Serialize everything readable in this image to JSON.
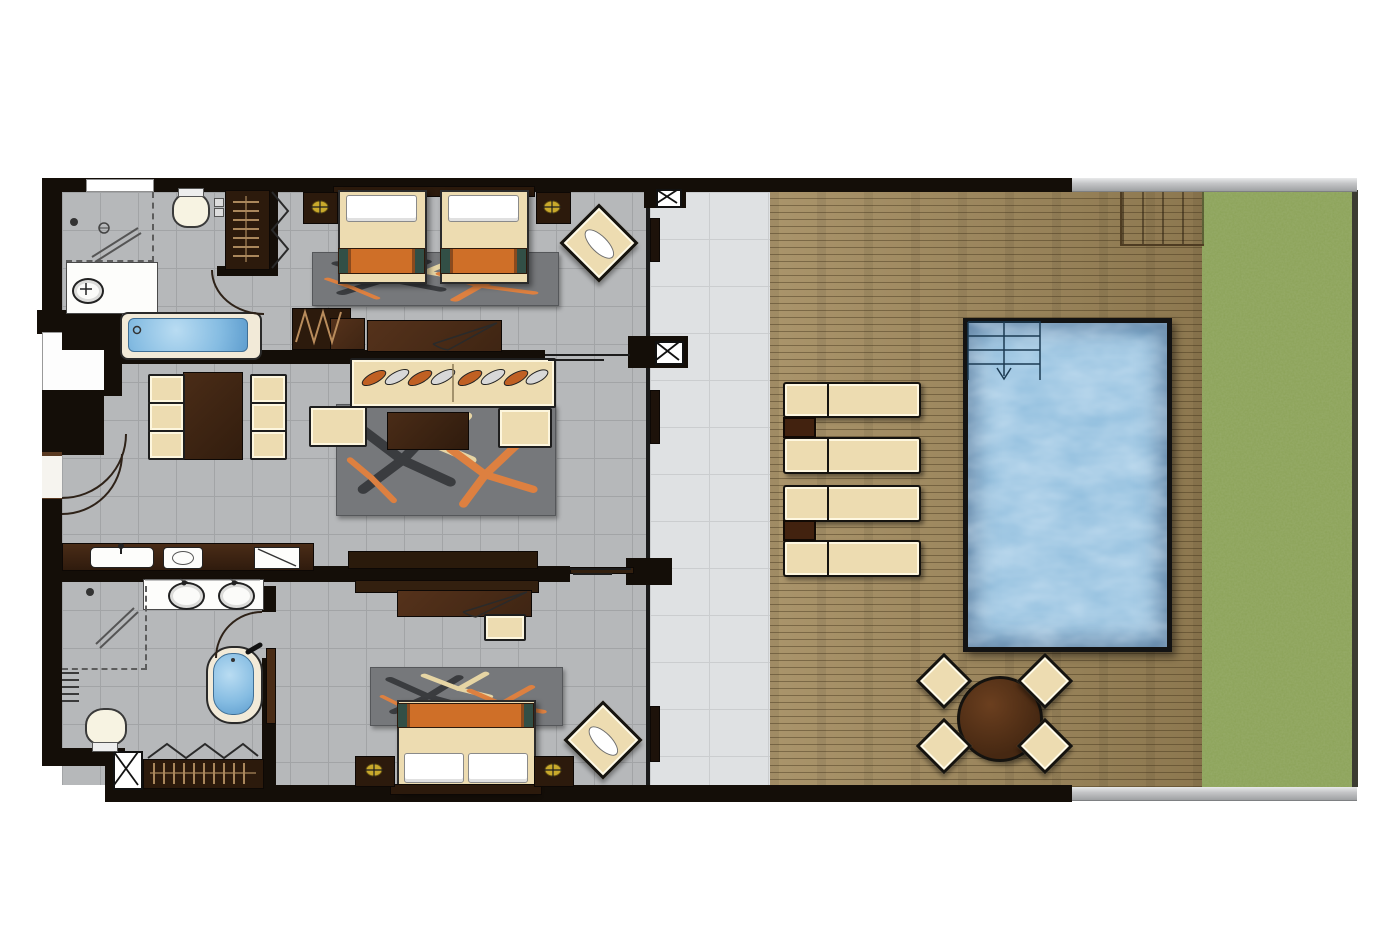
{
  "document": {
    "kind": "floor-plan",
    "text_labels": []
  },
  "colors": {
    "wall": "#140e08",
    "woodDark": "#2c1a0c",
    "wood": "#3f2513",
    "woodMid": "#55321b",
    "cream": "#eddcb1",
    "orange": "#cf6f28",
    "teal": "#324f46",
    "rugGray": "#76787b",
    "rugOrange": "#dd8040",
    "rugCream": "#e6d5a4",
    "rugCharcoal": "#3a3c3f",
    "tile": "#b6b8ba",
    "tileLine": "#a2a4a6",
    "terrace": "#dfe1e3",
    "terraceLine": "#cbcdcf",
    "deck": "#a0885a",
    "lawn": "#8ba257",
    "pool": "#8fbddd",
    "poolFrame": "#131313",
    "tubWater": "#85bce2",
    "grayBand": "#c5c6c8",
    "line": "#1e1e1e",
    "gold": "#c9a92c",
    "hanger": "#c09a6a",
    "glass": "#1a1a1a"
  },
  "plan": {
    "rooms": [
      "bathroom-1",
      "bedroom-1-twin",
      "living-dining",
      "kitchenette",
      "bathroom-2",
      "bedroom-2-king",
      "covered-terrace",
      "pool-deck",
      "lawn"
    ],
    "feature_counts": {
      "beds": 3,
      "twin_beds": 2,
      "king_beds": 1,
      "bathtubs": 2,
      "showers": 2,
      "toilets": 2,
      "wash_basins": 3,
      "wardrobes": 2,
      "dining_chairs_indoor": 6,
      "sun_loungers": 4,
      "outdoor_dining_chairs": 4,
      "private_pool": 1,
      "lounge_chairs": 2
    }
  }
}
